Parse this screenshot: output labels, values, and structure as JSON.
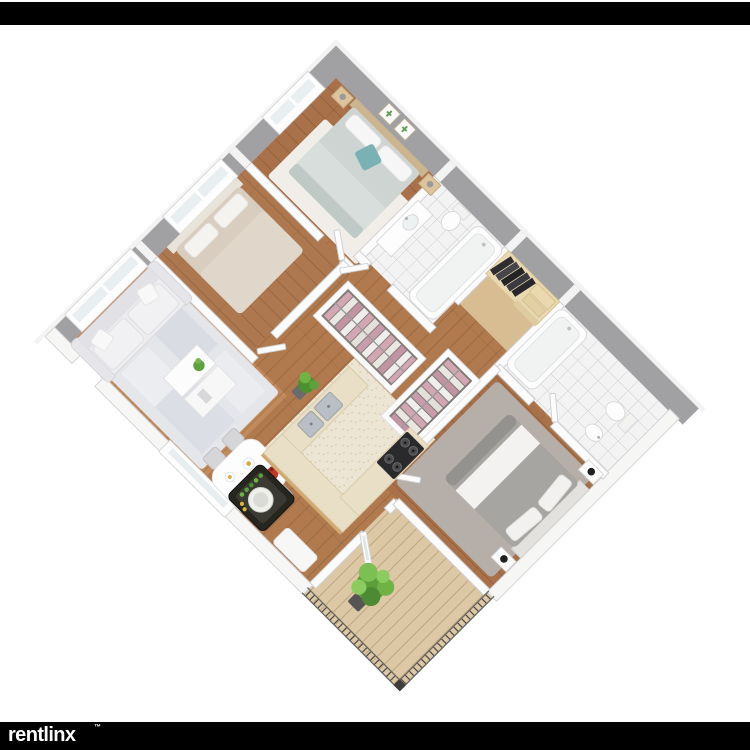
{
  "page": {
    "background": "#ffffff"
  },
  "top_bar": {
    "color": "#000000"
  },
  "bottom_bar": {
    "color": "#000000"
  },
  "logo": {
    "text": "rentlinx",
    "mark": "™",
    "color": "#ffffff"
  },
  "floorplan": {
    "kind": "3d-isometric-apartment-floor-plan",
    "rotation_deg": 45,
    "palette": {
      "exterior_wall": "#a1a1a4",
      "wall_cap": "#f3f3f3",
      "interior_wall": "#fbfbfb",
      "wood_hall": "#b07a4e",
      "wood_bedroom": "#a8714a",
      "wood_living": "#c08a5c",
      "closet_wood": "#d9bd92",
      "tile": "#f3f3f3",
      "tile_grid": "#c9ced5",
      "kitchen_floor": "#ece5d3",
      "counter_top": "#e9dfc7",
      "cabinet_wood": "#d0a973",
      "stove": "#2a2a2c",
      "sink_steel": "#b9bfc4",
      "living_rug": "#e4e6ea",
      "bedroom2_rug": "#b6afa9",
      "bedroom1_rug": "#f4f3f0",
      "sofa": "#ededef",
      "bed1_duvet": "#cdd4d1",
      "teal_pillow": "#7ab1b5",
      "bed2_duvet": "#a7a5a1",
      "bed3_duvet": "#d8cdbf",
      "pink_clothes": "#d3a6b4",
      "dark_clothes": "#2e2e31",
      "balcony_deck": "#ddc8a6",
      "railing": "#3f3e3b",
      "plant_green": "#6fb344",
      "flower_red": "#bf3a2b",
      "dark_cabinet": "#26261f"
    },
    "rooms": [
      {
        "id": "bedroom-1",
        "name": "Bedroom (top)",
        "floor": "wood",
        "furniture": [
          "double-bed-teal-pillow",
          "two-nightstands-lamps",
          "white-rug",
          "two-cactus-wall-pictures",
          "window"
        ]
      },
      {
        "id": "bathroom-1",
        "name": "Bathroom (top)",
        "floor": "white-tile",
        "furniture": [
          "vanity-sink",
          "toilet",
          "bathtub"
        ]
      },
      {
        "id": "walk-in-closet",
        "name": "Walk-in closet",
        "floor": "light-wood",
        "furniture": [
          "dark-hanging-clothes",
          "beige-storage-boxes",
          "shelf"
        ]
      },
      {
        "id": "bathroom-2",
        "name": "Bathroom (right)",
        "floor": "white-tile",
        "furniture": [
          "bathtub",
          "toilet",
          "pedestal-sink"
        ]
      },
      {
        "id": "bedroom-2",
        "name": "Bedroom (right)",
        "floor": "wood",
        "furniture": [
          "gray-white-bed",
          "gray-rug",
          "two-nightstands-black-lamps"
        ]
      },
      {
        "id": "bedroom-3",
        "name": "Bedroom (left)",
        "floor": "wood",
        "furniture": [
          "beige-bed",
          "window"
        ]
      },
      {
        "id": "closet-a",
        "name": "Closet (center-left)",
        "floor": "wood",
        "furniture": [
          "pink-white-hanging-clothes"
        ]
      },
      {
        "id": "closet-b",
        "name": "Closet (center-right)",
        "floor": "wood",
        "furniture": [
          "pink-white-hanging-clothes"
        ]
      },
      {
        "id": "living-room",
        "name": "Living room",
        "floor": "wood",
        "furniture": [
          "white-sofa",
          "split-coffee-table-plant",
          "mottled-rug",
          "wide-window"
        ]
      },
      {
        "id": "dining",
        "name": "Dining area",
        "floor": "wood",
        "furniture": [
          "white-table",
          "four-chairs",
          "red-flower-vase",
          "plates-of-food",
          "sw-window"
        ]
      },
      {
        "id": "kitchen",
        "name": "Kitchen",
        "floor": "speckled-cream",
        "furniture": [
          "u-shaped-counter",
          "double-steel-sink",
          "four-burner-stove"
        ]
      },
      {
        "id": "laundry-nook",
        "name": "Dark cabinet / washer nook",
        "floor": "wood",
        "furniture": [
          "dark-cabinet-white-drum",
          "green-bottles"
        ]
      },
      {
        "id": "balcony",
        "name": "Balcony",
        "floor": "wood-deck-planks",
        "furniture": [
          "metal-railing",
          "green-plant",
          "glass-door"
        ]
      },
      {
        "id": "hallway",
        "name": "Hallway",
        "floor": "wood",
        "furniture": [
          "potted-plant",
          "white-bench",
          "white-doors"
        ]
      }
    ]
  }
}
